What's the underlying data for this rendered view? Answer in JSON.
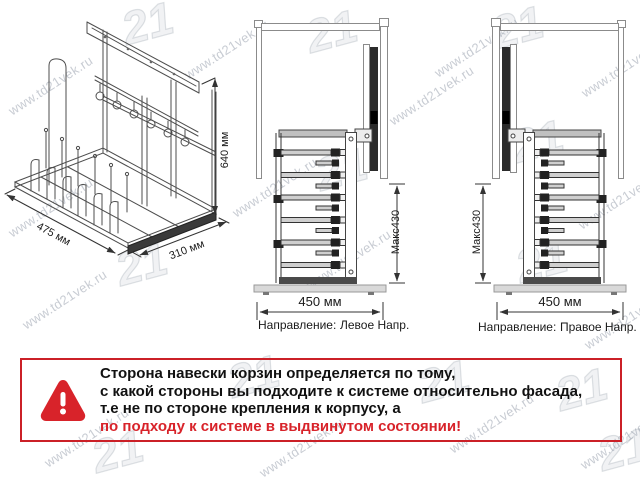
{
  "watermark": {
    "text": "www.td21vek.ru",
    "logo": "21"
  },
  "isometric": {
    "width_label": "475 мм",
    "depth_label": "310 мм",
    "height_label": "640 мм"
  },
  "left_view": {
    "opening_label": "450 мм",
    "max_height_label": "Макс430",
    "direction_label": "Направление:",
    "direction_value": "Левое Напр."
  },
  "right_view": {
    "opening_label": "450 мм",
    "max_height_label": "Макс430",
    "direction_label": "Направление:",
    "direction_value": "Правое Напр."
  },
  "warning": {
    "line1": "Сторона навески корзин определяется по тому,",
    "line2": "с какой стороны вы подходите к системе относительно фасада,",
    "line3": "т.е не по стороне крепления к корпусу, а",
    "line4": "по подходу к системе в выдвинутом состоянии!",
    "accent_color": "#d8232a"
  }
}
